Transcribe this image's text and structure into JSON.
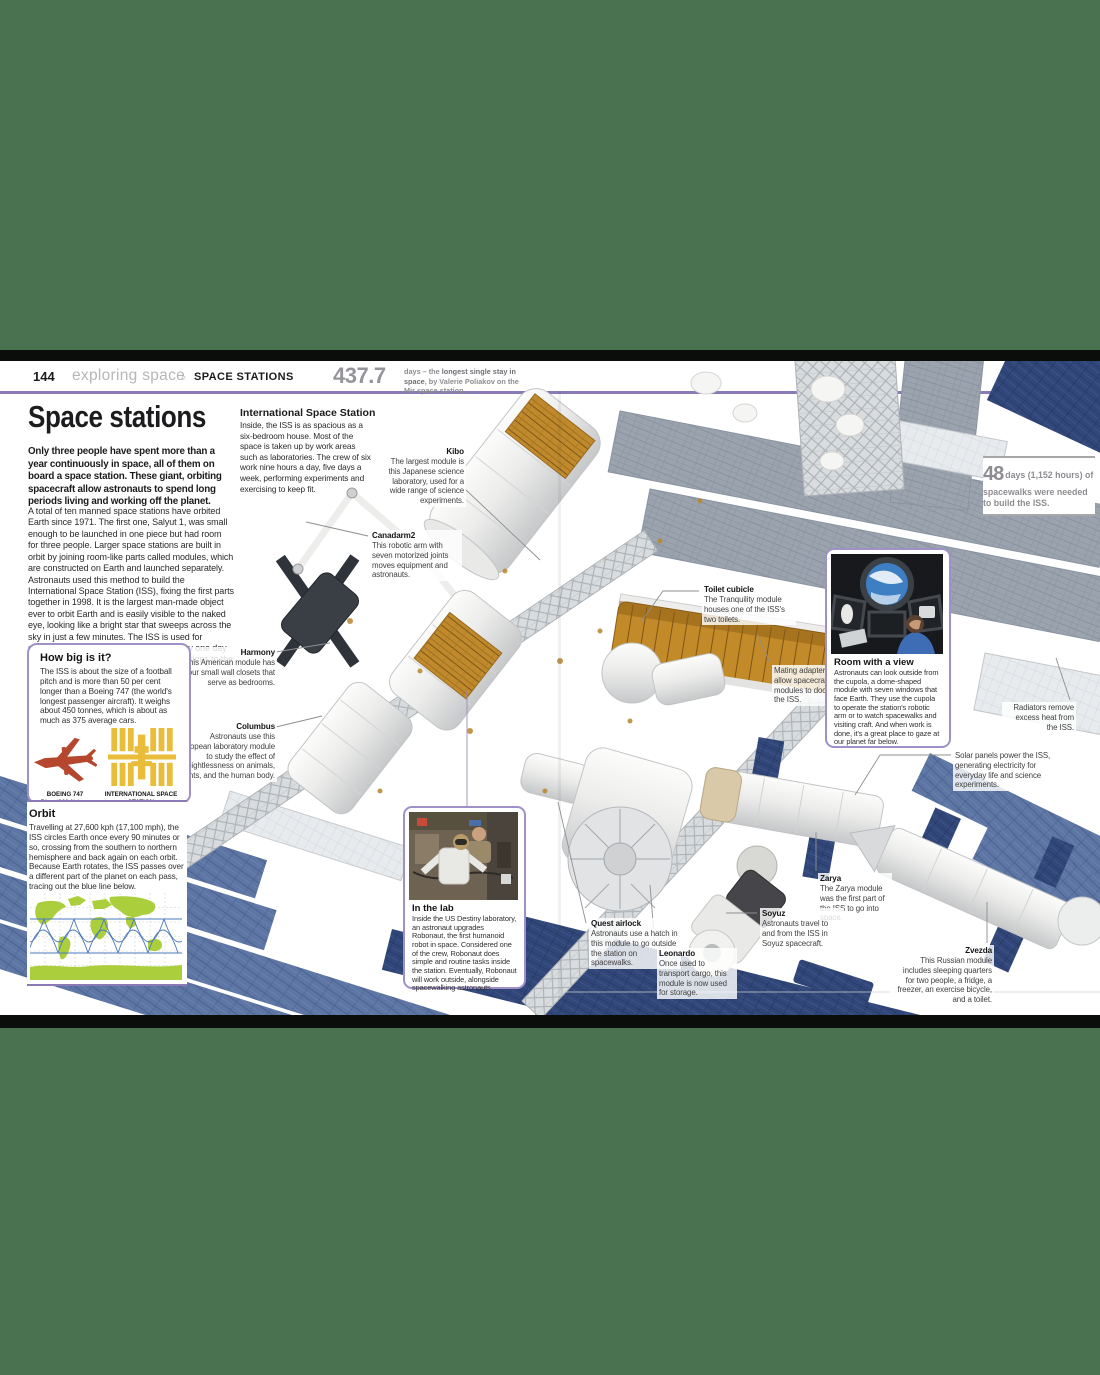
{
  "header": {
    "page_number": "144",
    "section": "exploring space",
    "separator": "○",
    "topic": "SPACE STATIONS",
    "stat": {
      "value": "437.7",
      "pre": "days – the ",
      "bold": "longest single stay in space",
      "post": ", by Valerie Poliakov on the Mir space station."
    }
  },
  "article": {
    "title": "Space stations",
    "intro": "Only three people have spent more than a year continuously in space, all of them on board a space station. These giant, orbiting spacecraft allow astronauts to spend long periods living and working off the planet.",
    "body": "A total of ten manned space stations have orbited Earth since 1971. The first one, Salyut 1, was small enough to be launched in one piece but had room for three people. Larger space stations are built in orbit by joining room-like parts called modules, which are constructed on Earth and launched separately. Astronauts used this method to build the International Space Station (ISS), fixing the first parts together in 1998. It is the largest man-made object ever to orbit Earth and is easily visible to the naked eye, looking like a bright star that sweeps across the sky in just a few minutes. The ISS is used for scientific research, but space stations may one day be used as staging posts for manned missions to the planets."
  },
  "iss_overview": {
    "heading": "International Space Station",
    "text": "Inside, the ISS is as spacious as a six-bedroom house. Most of the space is taken up by work areas such as laboratories. The crew of six work nine hours a day, five days a week, performing experiments and exercising to keep fit."
  },
  "spacewalk_stat": {
    "value": "48",
    "text": "days (1,152 hours) of spacewalks were needed to build the ISS."
  },
  "how_big": {
    "title": "How big is it?",
    "text": "The ISS is about the size of a football pitch and is more than 50 per cent longer than a Boeing 747 (the world's longest passenger aircraft). It weighs about 450 tonnes, which is about as much as 375 average cars.",
    "boeing_label": "BOEING 747",
    "boeing_length": "71 m (233 ft) long",
    "iss_label": "INTERNATIONAL SPACE STATION",
    "iss_length": "109 m (357 ft) long"
  },
  "orbit": {
    "title": "Orbit",
    "text": "Travelling at 27,600 kph (17,100 mph), the ISS circles Earth once every 90 minutes or so, crossing from the southern to northern hemisphere and back again on each orbit. Because Earth rotates, the ISS passes over a different part of the planet on each pass, tracing out the blue line below."
  },
  "room_with_a_view": {
    "title": "Room with a view",
    "text": "Astronauts can look outside from the cupola, a dome-shaped module with seven windows that face Earth. They use the cupola to operate the station's robotic arm or to watch spacewalks and visiting craft. And when work is done, it's a great place to gaze at our planet far below."
  },
  "in_the_lab": {
    "title": "In the lab",
    "text": "Inside the US Destiny laboratory, an astronaut upgrades Robonaut, the first humanoid robot in space. Considered one of the crew, Robonaut does simple and routine tasks inside the station. Eventually, Robonaut will work outside, alongside spacewalking astronauts."
  },
  "labels": {
    "kibo": {
      "name": "Kibo",
      "text": "The largest module is this Japanese science laboratory, used for a wide range of science experiments."
    },
    "canadarm2": {
      "name": "Canadarm2",
      "text": "This robotic arm with seven motorized joints moves equipment and astronauts."
    },
    "harmony": {
      "name": "Harmony",
      "text": "This American module has four small wall closets that serve as bedrooms."
    },
    "columbus": {
      "name": "Columbus",
      "text": "Astronauts use this European laboratory module to study the effect of weightlessness on animals, plants, and the human body."
    },
    "toilet_cubicle": {
      "name": "Toilet cubicle",
      "text": "The Tranquility module houses one of the ISS's two toilets."
    },
    "mating_adapters": {
      "text": "Mating adapters allow spacecraft and modules to dock with the ISS."
    },
    "radiators": {
      "text": "Radiators remove excess heat from the ISS."
    },
    "solar_panels": {
      "text": "Solar panels power the ISS, generating electricity for everyday life and science experiments."
    },
    "zarya": {
      "name": "Zarya",
      "text": "The Zarya module was the first part of the ISS to go into space."
    },
    "soyuz": {
      "name": "Soyuz",
      "text": "Astronauts travel to and from the ISS in Soyuz spacecraft."
    },
    "quest_airlock": {
      "name": "Quest airlock",
      "text": "Astronauts use a hatch in this module to go outside the station on spacewalks."
    },
    "leonardo": {
      "name": "Leonardo",
      "text": "Once used to transport cargo, this module is now used for storage."
    },
    "zvezda": {
      "name": "Zvezda",
      "text": "This Russian module includes sleeping quarters for two people, a fridge, a freezer, an exercise bicycle, and a toilet."
    }
  },
  "colors": {
    "accent_purple": "#8a7ab5",
    "stat_gray": "#96949a",
    "solar_navy": "#31477a",
    "solar_slate": "#5e76a4",
    "gold_interior": "#c28a28",
    "land_green": "#aace3c",
    "orbit_blue": "#4d79bb",
    "plane_red": "#b5472e",
    "iss_icon_yellow": "#e9bd3a",
    "border_green": "#4a7150"
  }
}
